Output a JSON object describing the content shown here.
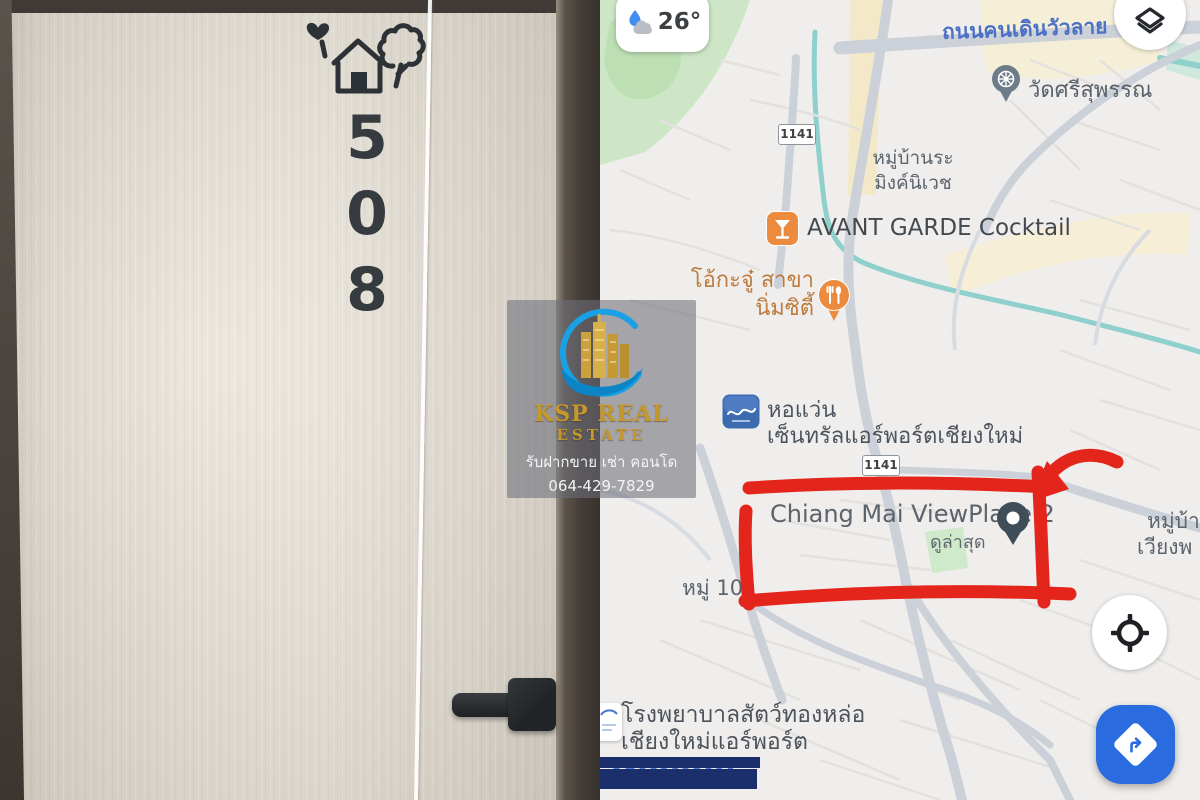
{
  "door_photo": {
    "room_number": "508",
    "digits": [
      "5",
      "0",
      "8"
    ],
    "sign_icon": "house-heart-tree-sign"
  },
  "watermark": {
    "brand_top": "KSP REAL",
    "brand_bottom": "ESTATE",
    "tagline": "รับฝากขาย เช่า คอนโด",
    "phone": "064-429-7829"
  },
  "map": {
    "weather_temp": "26°",
    "road_label_top": "ถนนคนเดินวัวลาย",
    "badge_1": "1141",
    "badge_2": "1141",
    "temple_label": "วัดศรีสุพรรณ",
    "village_line1": "หมู่บ้านระ",
    "village_line2": "มิงค์นิเวช",
    "cocktail_label": "AVANT GARDE Cocktail",
    "restaurant_line1": "โอ้กะจู๋ สาขา",
    "restaurant_line2": "นิ่มซิตี้",
    "optical_line1": "หอแว่น",
    "optical_line2": "เซ็นทรัลแอร์พอร์ตเชียงใหม่",
    "place_label": "Chiang Mai ViewPlace 2",
    "place_sub": "ดูล่าสุด",
    "edge_line1": "หมู่บ้า",
    "edge_line2": "เวียงพ",
    "moo_label": "หมู่ 10",
    "hospital_line1": "โรงพยาบาลสัตว์ทองหล่อ",
    "hospital_line2": "เชียงใหม่แอร์พอร์ต",
    "attribution": "Google",
    "colors": {
      "annotation_red": "#e3251b",
      "fab_blue": "#2a6be0",
      "poi_orange": "#ec8b3e",
      "road_label_blue": "#4a71c6",
      "censor_navy": "#1c2f6d"
    }
  }
}
